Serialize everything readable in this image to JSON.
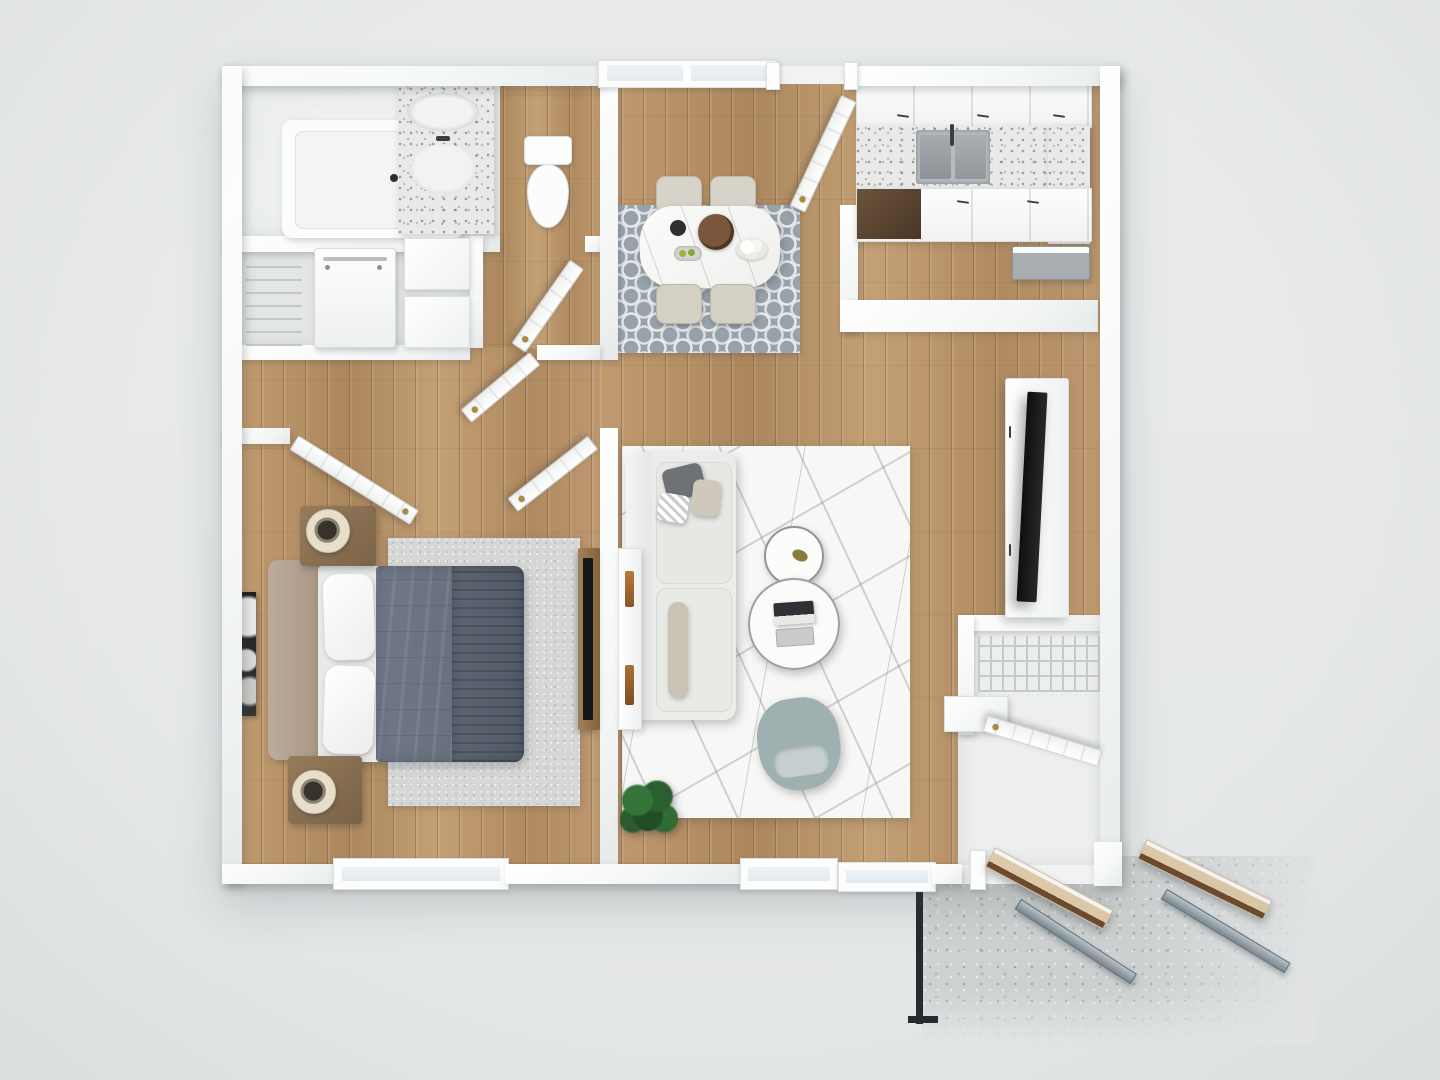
{
  "scene": {
    "label": "3D rendered one-bedroom apartment floor plan, top-down view",
    "background": "#e8eaeb"
  },
  "palette": {
    "background": "#e8eaeb",
    "wall_white": "#fbfcfc",
    "wall_shadow": "#d8dbdc",
    "wood_floor": "#b9946a",
    "tile_floor": "#eef0f0",
    "dining_rug": "#97a2ab",
    "dining_rug_lattice": "#e7e9ea",
    "bedroom_rug": "#d5d6d6",
    "marble_rug": "#f7f7f6",
    "duvet_gray": "#68707e",
    "duvet_dark": "#5d6573",
    "headboard_taupe": "#b4a292",
    "nightstand_wood": "#8a7154",
    "sofa_white": "#ececea",
    "accent_chair": "#9fb0b0",
    "granite_counter": "#e9eae8",
    "stainless_sink": "#9aa0a4",
    "dark_cabinet": "#5b4632",
    "tv_black": "#17181a",
    "gold_hardware": "#a98a3f",
    "concrete": "#cfd2d2",
    "patio_door_wood": "#ddc8a8",
    "plant_green": "#2f6b33"
  },
  "rooms": {
    "bathroom": {
      "label": "Bathroom",
      "items": [
        "bathtub",
        "granite vanity with sink",
        "mirror",
        "toilet"
      ]
    },
    "laundry_closet": {
      "label": "Laundry closet",
      "items": [
        "washer-dryer unit",
        "wire shelving",
        "linen shelves"
      ]
    },
    "hallway": {
      "label": "Hallway",
      "items": [
        "bathroom door",
        "linen closet door",
        "bedroom double doors"
      ]
    },
    "dining": {
      "label": "Dining area",
      "items": [
        "oval marble dining table",
        "four upholstered chairs",
        "gray trellis rug",
        "wood serving tray",
        "recessed window"
      ]
    },
    "kitchen": {
      "label": "Kitchen",
      "items": [
        "upper cabinets",
        "granite countertop",
        "stainless double sink",
        "lower cabinets",
        "dark dishwasher panel",
        "refrigerator"
      ]
    },
    "living": {
      "label": "Living room",
      "items": [
        "white sectional sofa",
        "marble-pattern area rug",
        "two round nesting coffee tables",
        "gray accent chair",
        "potted plant",
        "white TV console",
        "flat-screen TV"
      ]
    },
    "bedroom": {
      "label": "Bedroom",
      "items": [
        "bed with gray duvet",
        "two wood nightstands",
        "two drum lamps",
        "light gray rug",
        "framed wall art",
        "media dresser with TV"
      ]
    },
    "entry": {
      "label": "Entry",
      "items": [
        "front door",
        "coat closet with wire shelving",
        "closet door",
        "white bench cabinet"
      ]
    },
    "patio": {
      "label": "Patio",
      "items": [
        "concrete slab",
        "two open patio doors",
        "two screen panels",
        "black metal railing"
      ]
    }
  }
}
